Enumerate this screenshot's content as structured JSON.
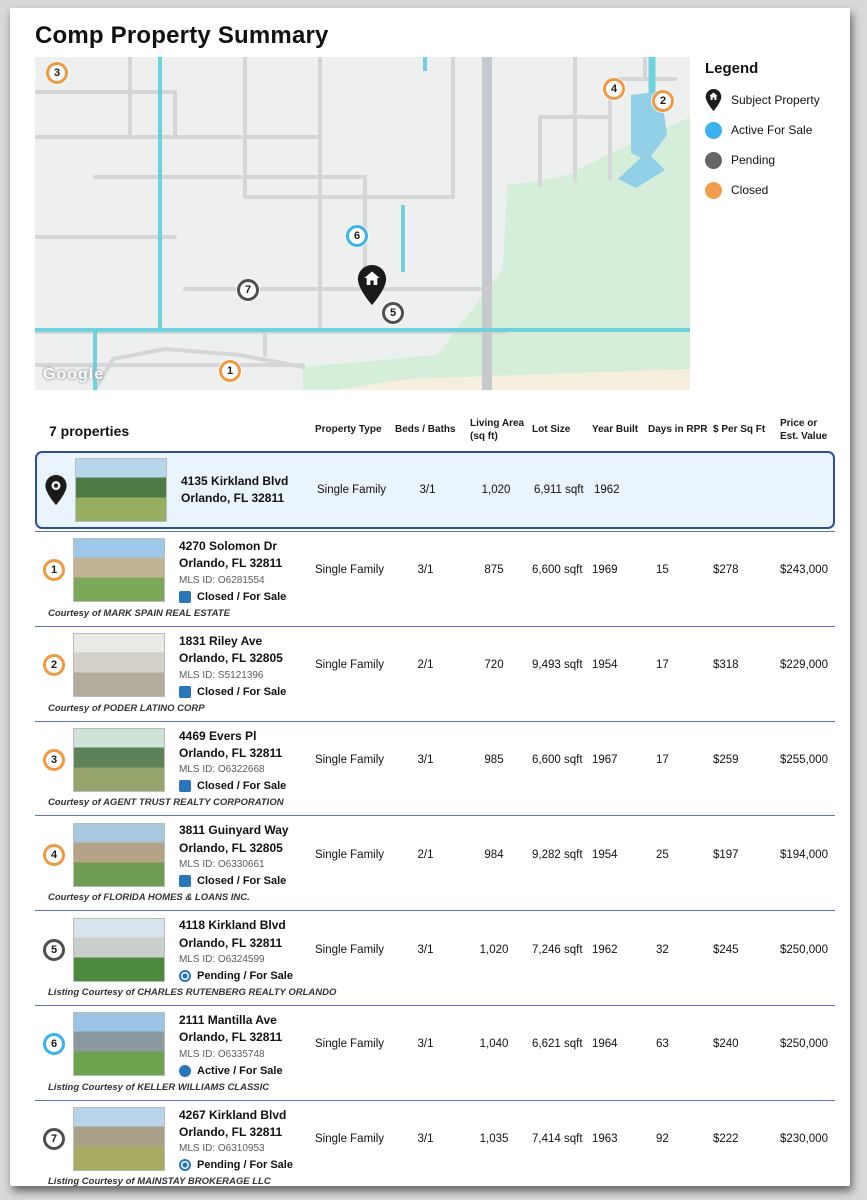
{
  "page": {
    "title": "Comp Property Summary"
  },
  "colors": {
    "active": "#3db1ee",
    "pending": "#4f4f4f",
    "closed": "#ef9a43",
    "status_blue": "#2a76bd",
    "subject_border": "#2b4f9e",
    "subject_bg": "#eaf4fc",
    "separator": "#6272b5"
  },
  "map": {
    "attribution": "Google",
    "subject_pin": {
      "x": 337,
      "y": 246
    },
    "markers": [
      {
        "num": "3",
        "type": "closed",
        "x": 22,
        "y": 16
      },
      {
        "num": "4",
        "type": "closed",
        "x": 579,
        "y": 32
      },
      {
        "num": "2",
        "type": "closed",
        "x": 628,
        "y": 44
      },
      {
        "num": "6",
        "type": "active",
        "x": 322,
        "y": 179
      },
      {
        "num": "7",
        "type": "pending",
        "x": 213,
        "y": 233
      },
      {
        "num": "5",
        "type": "pending",
        "x": 358,
        "y": 256
      },
      {
        "num": "1",
        "type": "closed",
        "x": 195,
        "y": 314
      }
    ]
  },
  "legend": {
    "title": "Legend",
    "items": [
      {
        "label": "Subject Property",
        "type": "subject",
        "color": "#1b1b1b"
      },
      {
        "label": "Active For Sale",
        "type": "active",
        "color": "#3db1ee"
      },
      {
        "label": "Pending",
        "type": "pending",
        "color": "#666666"
      },
      {
        "label": "Closed",
        "type": "closed",
        "color": "#f09d4e"
      }
    ]
  },
  "table": {
    "count_label": "7 properties",
    "columns": [
      {
        "line1": "Property Type",
        "line2": ""
      },
      {
        "line1": "Beds / Baths",
        "line2": ""
      },
      {
        "line1": "Living Area",
        "line2": "(sq ft)"
      },
      {
        "line1": "Lot Size",
        "line2": ""
      },
      {
        "line1": "Year Built",
        "line2": ""
      },
      {
        "line1": "Days in RPR",
        "line2": ""
      },
      {
        "line1": "$ Per Sq Ft",
        "line2": ""
      },
      {
        "line1": "Price or",
        "line2": "Est. Value"
      }
    ],
    "subject": {
      "address1": "4135 Kirkland Blvd",
      "address2": "Orlando, FL 32811",
      "ptype": "Single Family",
      "beds": "3/1",
      "living": "1,020",
      "lot": "6,911 sqft",
      "year": "1962",
      "days": "",
      "ppsf": "",
      "price": "",
      "photo": [
        "#b7d6ea",
        "#4d7a45",
        "#97ad62"
      ]
    },
    "rows": [
      {
        "num": "1",
        "ring": "closed",
        "address1": "4270 Solomon Dr",
        "address2": "Orlando, FL 32811",
        "mls": "MLS ID: O6281554",
        "status_icon": "square",
        "status_text": "Closed / For Sale",
        "ptype": "Single Family",
        "beds": "3/1",
        "living": "875",
        "lot": "6,600 sqft",
        "year": "1969",
        "days": "15",
        "ppsf": "$278",
        "price": "$243,000",
        "courtesy": "Courtesy of MARK SPAIN REAL ESTATE",
        "photo": [
          "#9fc8e8",
          "#c2b294",
          "#7da75a"
        ]
      },
      {
        "num": "2",
        "ring": "closed",
        "address1": "1831 Riley Ave",
        "address2": "Orlando, FL 32805",
        "mls": "MLS ID: S5121396",
        "status_icon": "square",
        "status_text": "Closed / For Sale",
        "ptype": "Single Family",
        "beds": "2/1",
        "living": "720",
        "lot": "9,493 sqft",
        "year": "1954",
        "days": "17",
        "ppsf": "$318",
        "price": "$229,000",
        "courtesy": "Courtesy of PODER LATINO CORP",
        "photo": [
          "#eceae6",
          "#d3d0ca",
          "#b3ab9c"
        ]
      },
      {
        "num": "3",
        "ring": "closed",
        "address1": "4469 Evers Pl",
        "address2": "Orlando, FL 32811",
        "mls": "MLS ID: O6322668",
        "status_icon": "square",
        "status_text": "Closed / For Sale",
        "ptype": "Single Family",
        "beds": "3/1",
        "living": "985",
        "lot": "6,600 sqft",
        "year": "1967",
        "days": "17",
        "ppsf": "$259",
        "price": "$255,000",
        "courtesy": "Courtesy of AGENT TRUST REALTY CORPORATION",
        "photo": [
          "#cfe3d8",
          "#5d8257",
          "#94a46a"
        ]
      },
      {
        "num": "4",
        "ring": "closed",
        "address1": "3811 Guinyard Way",
        "address2": "Orlando, FL 32805",
        "mls": "MLS ID: O6330661",
        "status_icon": "square",
        "status_text": "Closed / For Sale",
        "ptype": "Single Family",
        "beds": "2/1",
        "living": "984",
        "lot": "9,282 sqft",
        "year": "1954",
        "days": "25",
        "ppsf": "$197",
        "price": "$194,000",
        "courtesy": "Courtesy of FLORIDA HOMES & LOANS INC.",
        "photo": [
          "#a8c8e0",
          "#b5a287",
          "#6e9c50"
        ]
      },
      {
        "num": "5",
        "ring": "pending",
        "address1": "4118 Kirkland Blvd",
        "address2": "Orlando, FL 32811",
        "mls": "MLS ID: O6324599",
        "status_icon": "pending",
        "status_text": "Pending / For Sale",
        "ptype": "Single Family",
        "beds": "3/1",
        "living": "1,020",
        "lot": "7,246 sqft",
        "year": "1962",
        "days": "32",
        "ppsf": "$245",
        "price": "$250,000",
        "courtesy": "Listing Courtesy of CHARLES RUTENBERG REALTY ORLANDO",
        "photo": [
          "#d8e4ec",
          "#c9cfcb",
          "#4e8a3e"
        ]
      },
      {
        "num": "6",
        "ring": "active",
        "address1": "2111 Mantilla Ave",
        "address2": "Orlando, FL 32811",
        "mls": "MLS ID: O6335748",
        "status_icon": "active",
        "status_text": "Active / For Sale",
        "ptype": "Single Family",
        "beds": "3/1",
        "living": "1,040",
        "lot": "6,621 sqft",
        "year": "1964",
        "days": "63",
        "ppsf": "$240",
        "price": "$250,000",
        "courtesy": "Listing Courtesy of KELLER WILLIAMS CLASSIC",
        "photo": [
          "#9cc4e4",
          "#8b9aa0",
          "#6da24e"
        ]
      },
      {
        "num": "7",
        "ring": "pending",
        "address1": "4267 Kirkland Blvd",
        "address2": "Orlando, FL 32811",
        "mls": "MLS ID: O6310953",
        "status_icon": "pending",
        "status_text": "Pending / For Sale",
        "ptype": "Single Family",
        "beds": "3/1",
        "living": "1,035",
        "lot": "7,414 sqft",
        "year": "1963",
        "days": "92",
        "ppsf": "$222",
        "price": "$230,000",
        "courtesy": "Listing Courtesy of MAINSTAY BROKERAGE LLC",
        "photo": [
          "#b8d4ea",
          "#a9a08a",
          "#a8ab62"
        ]
      }
    ]
  }
}
